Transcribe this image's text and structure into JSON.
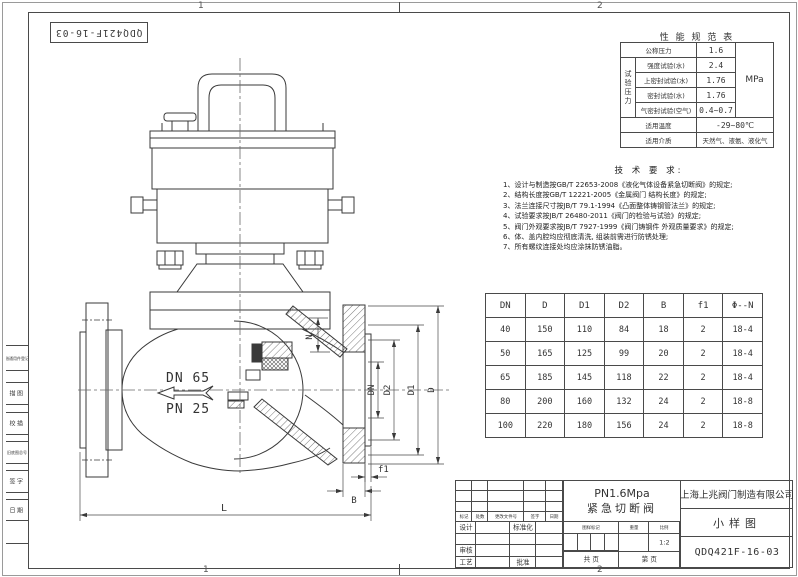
{
  "sheet": {
    "corner_id": "QDQ421F-16-03",
    "zone1": "1",
    "zone2": "2"
  },
  "margin_labels": {
    "borrow": "借通用件登记",
    "trace": "描图",
    "check_trace": "校描",
    "old_no": "旧底图总号",
    "sign": "签字",
    "date": "日期"
  },
  "perf_table": {
    "title": "性 能 规 范 表",
    "nominal_label": "公称压力",
    "nominal_value": "1.6",
    "group_label": "试验压力",
    "unit": "MPa",
    "rows": [
      {
        "label": "强度试验(水)",
        "value": "2.4"
      },
      {
        "label": "上密封试验(水)",
        "value": "1.76"
      },
      {
        "label": "密封试验(水)",
        "value": "1.76"
      },
      {
        "label": "气密封试验(空气)",
        "value": "0.4~0.7"
      }
    ],
    "temp_label": "适用温度",
    "temp_value": "-29~80℃",
    "media_label": "适用介质",
    "media_value": "天然气、液氨、液化气"
  },
  "tech_req": {
    "title": "技 术 要 求:",
    "items": [
      "1、设计与制造按GB/T 22653-2008《液化气体设备紧急切断阀》的规定;",
      "2、结构长度按GB/T 12221-2005《金属阀门 结构长度》的规定;",
      "3、法兰连接尺寸按JB/T 79.1-1994《凸面整体铸钢管法兰》的规定;",
      "4、试验要求按JB/T 26480-2011《阀门的检验与试验》的规定;",
      "5、阀门外观要求按JB/T 7927-1999《阀门铸钢件 外观质量要求》的规定;",
      "6、体、盖内腔均应彻底清洗, 组装前需进行防锈处理;",
      "7、所有螺纹连接处均应涂抹防锈油脂。"
    ]
  },
  "dim_table": {
    "headers": [
      "DN",
      "D",
      "D1",
      "D2",
      "B",
      "f1",
      "Φ--N"
    ],
    "rows": [
      [
        "40",
        "150",
        "110",
        "84",
        "18",
        "2",
        "18-4"
      ],
      [
        "50",
        "165",
        "125",
        "99",
        "20",
        "2",
        "18-4"
      ],
      [
        "65",
        "185",
        "145",
        "118",
        "22",
        "2",
        "18-4"
      ],
      [
        "80",
        "200",
        "160",
        "132",
        "24",
        "2",
        "18-8"
      ],
      [
        "100",
        "220",
        "180",
        "156",
        "24",
        "2",
        "18-8"
      ]
    ]
  },
  "title_block": {
    "rev_headers": [
      "标记",
      "处数",
      "更改文件号",
      "签字",
      "日期"
    ],
    "roles": {
      "design": "设计",
      "standardize": "标准化",
      "check": "审核",
      "process": "工艺",
      "approve": "批准"
    },
    "product_line1": "PN1.6Mpa",
    "product_line2": "紧急切断阀",
    "stamp_label": "图样标记",
    "weight_label": "重量",
    "scale_label": "比例",
    "scale_value": "1:2",
    "sheet_total": "共  页",
    "sheet_no": "第  页",
    "company": "上海上兆阀门制造有限公司",
    "doc_type": "小样图",
    "drawing_no": "QDQ421F-16-03"
  },
  "drawing_labels": {
    "dn": "DN 65",
    "pn": "PN 25",
    "dim_n": "N",
    "dim_dn": "DN",
    "dim_d2": "D2",
    "dim_d1": "D1",
    "dim_d": "D",
    "dim_b": "B",
    "dim_f1": "f1",
    "dim_l": "L"
  }
}
